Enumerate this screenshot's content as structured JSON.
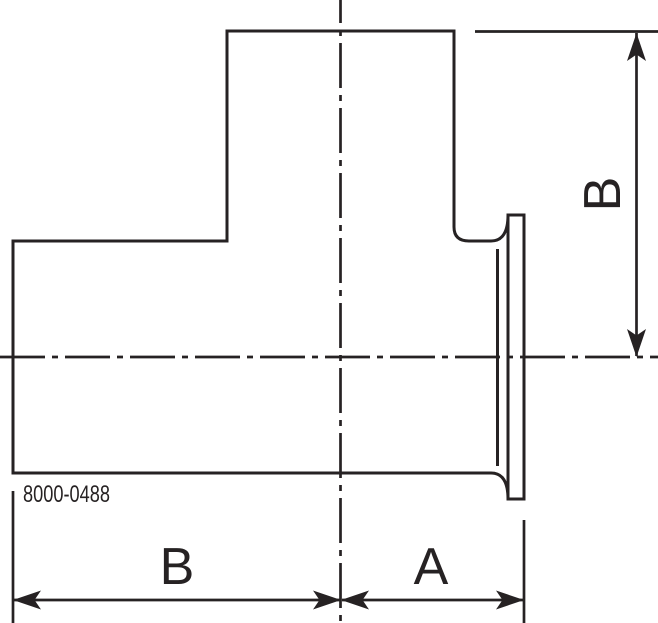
{
  "drawing": {
    "part_number": "8000-0488",
    "dimension_labels": {
      "vertical_b": "B",
      "horizontal_b": "B",
      "horizontal_a": "A"
    }
  },
  "colors": {
    "line": "#262223",
    "background": "#ffffff"
  }
}
